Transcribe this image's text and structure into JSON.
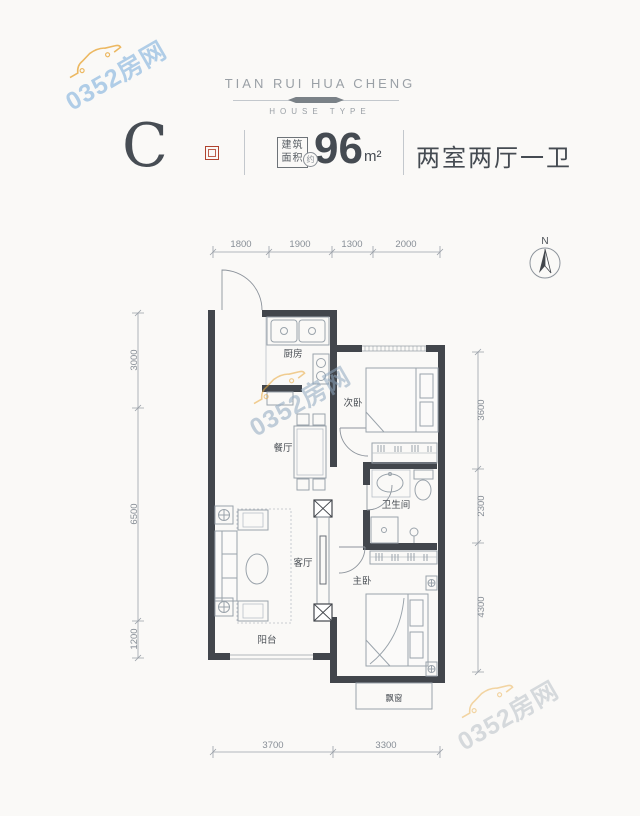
{
  "watermark": {
    "text": "0352房网"
  },
  "header": {
    "brand": "TIAN RUI HUA CHENG",
    "subtitle": "HOUSE TYPE"
  },
  "unit": {
    "type_letter": "C",
    "area_label_line1": "建筑",
    "area_label_line2": "面积",
    "approx": "约",
    "area_value": "96",
    "area_unit": "m²",
    "layout": "两室两厅一卫"
  },
  "compass": {
    "north": "N"
  },
  "rooms": {
    "kitchen": "厨房",
    "bedroom2": "次卧",
    "dining": "餐厅",
    "bathroom": "卫生间",
    "living": "客厅",
    "master": "主卧",
    "balcony": "阳台",
    "bay_window": "飘窗"
  },
  "dimensions": {
    "top": [
      "1800",
      "1900",
      "1300",
      "2000"
    ],
    "left": [
      "3000",
      "6500",
      "1200"
    ],
    "right": [
      "3600",
      "2300",
      "4300"
    ],
    "bottom": [
      "3700",
      "3300"
    ]
  },
  "colors": {
    "wall": "#42464c",
    "accent_red": "#b0432e",
    "watermark_blue": "#9ec3e4",
    "watermark_orange": "#e9a93d",
    "text_dark": "#454b52",
    "text_gray": "#9aa0a6"
  }
}
